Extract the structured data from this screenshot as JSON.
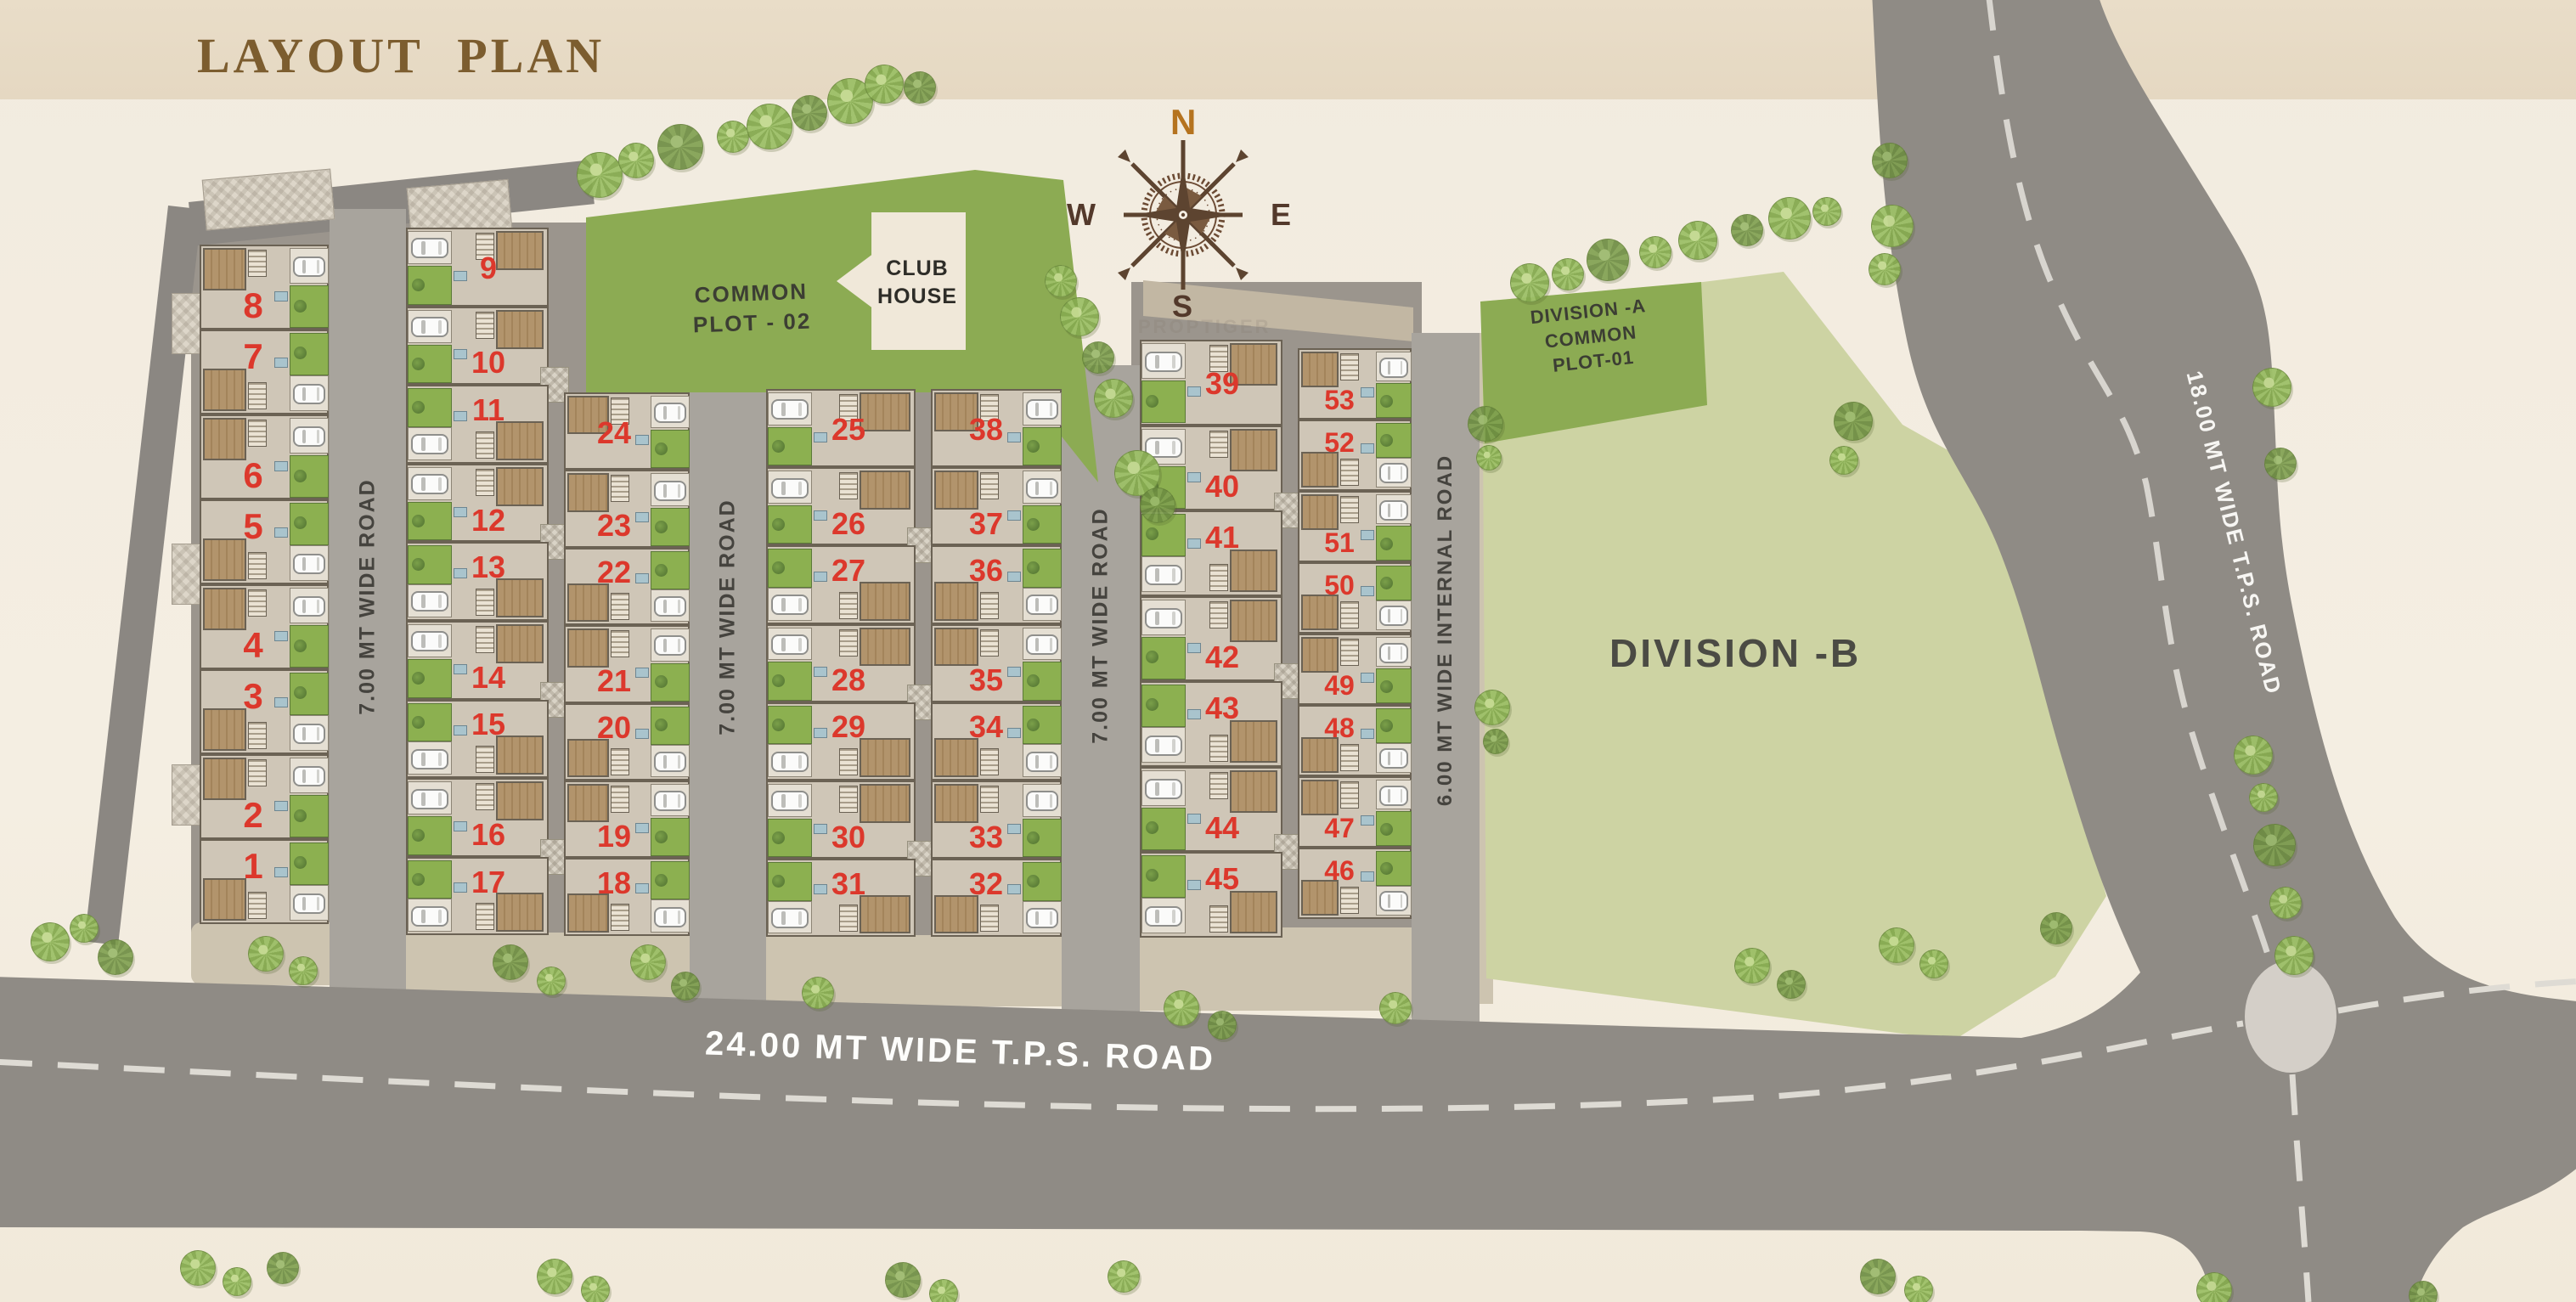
{
  "title": "LAYOUT PLAN",
  "watermark": "PROPTIGER",
  "compass": {
    "n": "N",
    "e": "E",
    "s": "S",
    "w": "W"
  },
  "common_plot_02": {
    "line1": "COMMON",
    "line2": "PLOT - 02"
  },
  "club_house": {
    "line1": "CLUB",
    "line2": "HOUSE"
  },
  "division_a": {
    "line1": "DIVISION -A",
    "line2": "COMMON",
    "line3": "PLOT-01"
  },
  "division_b": {
    "label": "DIVISION -B"
  },
  "roads": {
    "road1": "7.00 MT WIDE ROAD",
    "road2": "7.00 MT WIDE ROAD",
    "road3": "7.00 MT WIDE ROAD",
    "internal": "6.00 MT WIDE INTERNAL ROAD",
    "tps24": "24.00 MT WIDE T.P.S. ROAD",
    "tps18": "18.00 MT WIDE T.P.S. ROAD"
  },
  "colors": {
    "plot_number": "#dc382c",
    "common_green": "#8cab53",
    "division_b_green": "#cdd3a3",
    "road_gray": "#8f8b85",
    "title_brown": "#7c5d2f"
  },
  "blocks": [
    {
      "id": "col1",
      "plots": [
        "8",
        "7",
        "6",
        "5",
        "4",
        "3",
        "2",
        "1"
      ]
    },
    {
      "id": "col2",
      "plots": [
        "9",
        "10",
        "11",
        "12",
        "13",
        "14",
        "15",
        "16",
        "17"
      ]
    },
    {
      "id": "col3",
      "plots": [
        "24",
        "23",
        "22",
        "21",
        "20",
        "19",
        "18"
      ]
    },
    {
      "id": "col4",
      "plots": [
        "25",
        "26",
        "27",
        "28",
        "29",
        "30",
        "31"
      ]
    },
    {
      "id": "col5",
      "plots": [
        "38",
        "37",
        "36",
        "35",
        "34",
        "33",
        "32"
      ]
    },
    {
      "id": "col6",
      "plots": [
        "39",
        "40",
        "41",
        "42",
        "43",
        "44",
        "45"
      ]
    },
    {
      "id": "col7",
      "plots": [
        "53",
        "52",
        "51",
        "50",
        "49",
        "48",
        "47",
        "46"
      ]
    }
  ]
}
